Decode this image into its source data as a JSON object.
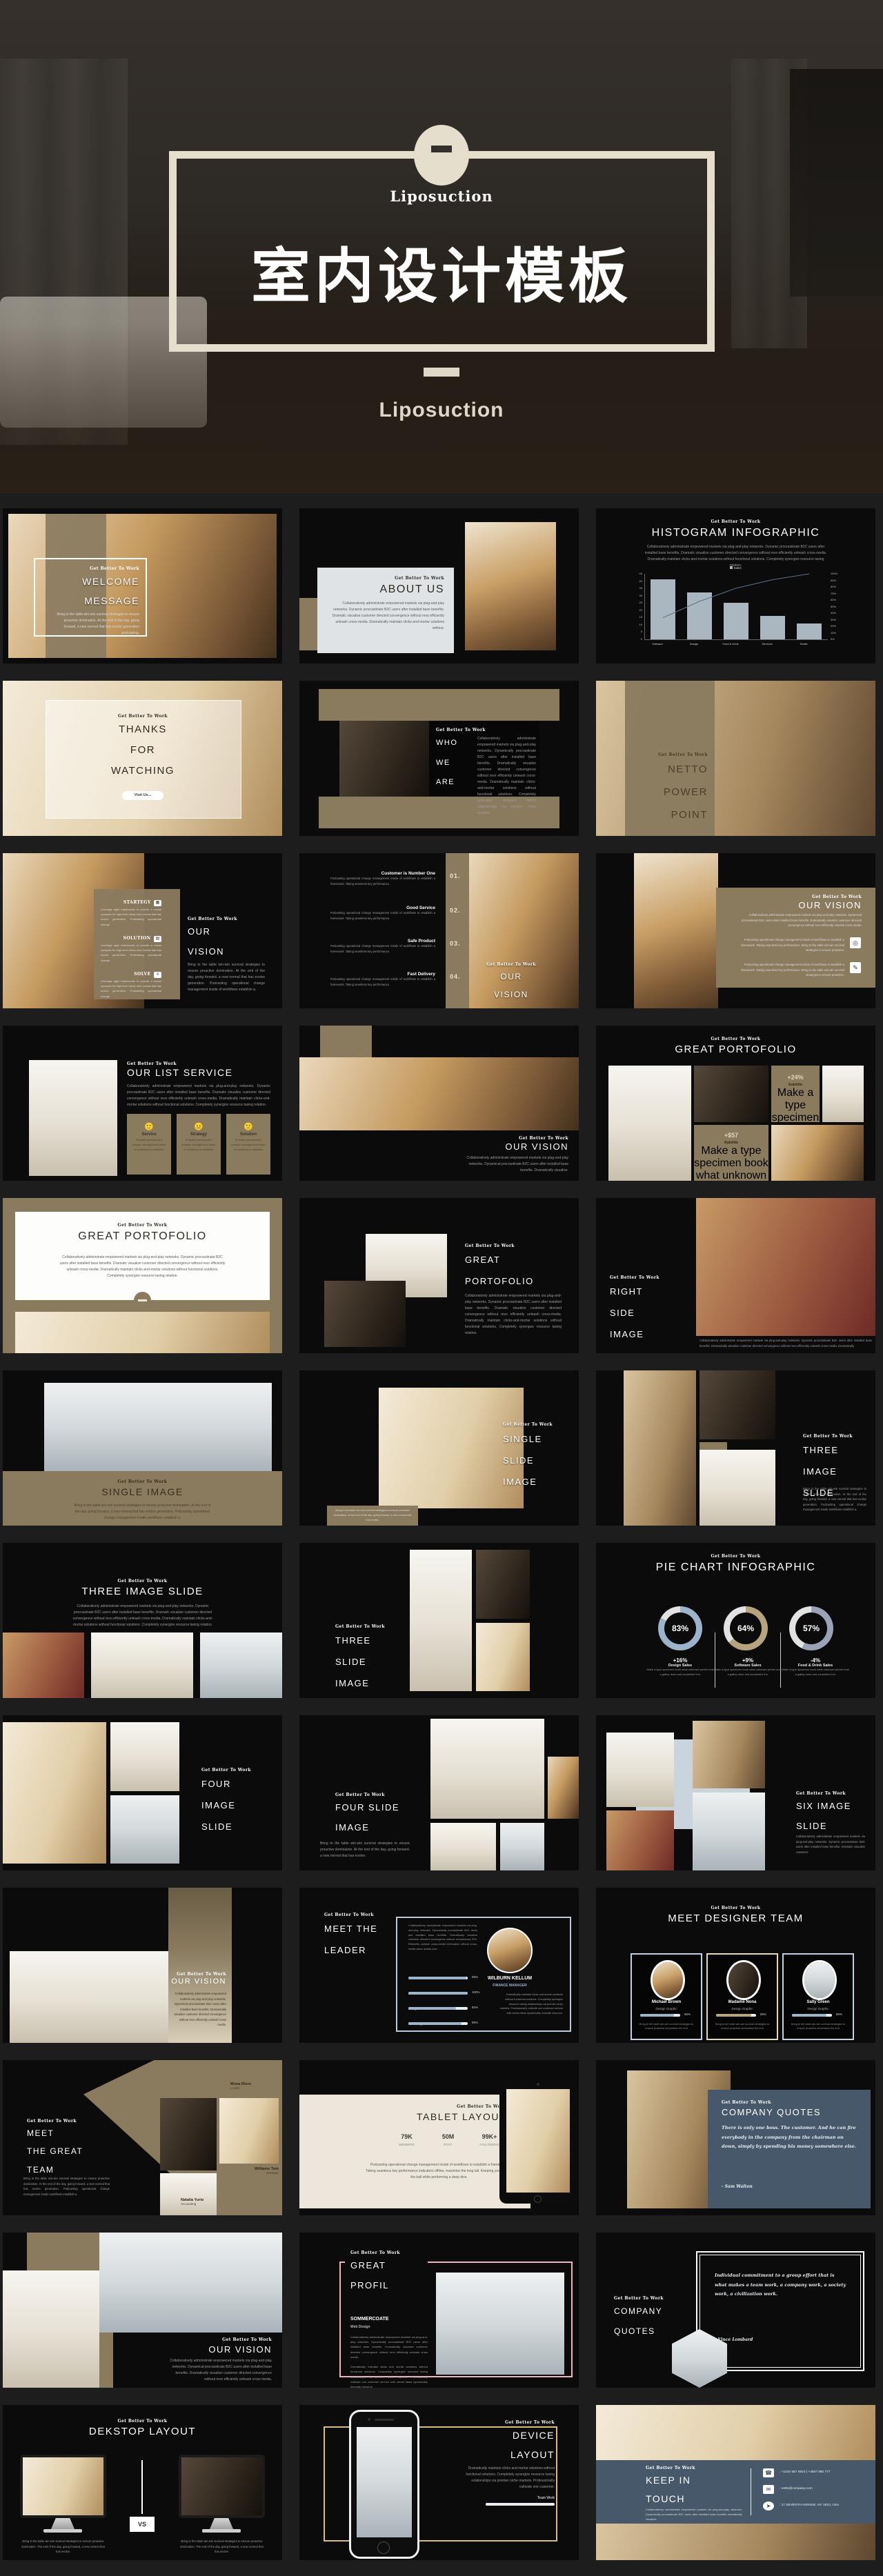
{
  "common": {
    "tagline": "Get Better To Work"
  },
  "hero": {
    "brand": "Liposuction",
    "title": "室内设计模板",
    "subtitle": "Liposuction"
  },
  "chart_data": [
    {
      "type": "bar",
      "title": "HISTOGRAM INFOGRAPHIC",
      "categories": [
        "Software",
        "Design",
        "Food & Drink",
        "Services",
        "Textile"
      ],
      "values": [
        41,
        32,
        25,
        16,
        11
      ],
      "cumulative_pct": [
        33,
        58,
        78,
        91,
        100
      ],
      "legend": [
        "Sales"
      ],
      "ylim": [
        0,
        45
      ],
      "y_ticks": [
        0,
        5,
        10,
        15,
        20,
        25,
        30,
        35,
        40,
        45
      ],
      "y2_ticks_pct": [
        0,
        10,
        20,
        30,
        40,
        50,
        60,
        70,
        80,
        90,
        100
      ],
      "bar_color": "#aab6c0",
      "line_color": "#5b7288"
    },
    {
      "type": "pie",
      "title": "PIE CHART INFOGRAPHIC",
      "slices": [
        {
          "pct": 83,
          "delta": "+16%",
          "label": "Design Sales",
          "color": "#9db3c9"
        },
        {
          "pct": 64,
          "delta": "+9%",
          "label": "Software Sales",
          "color": "#b5a47e"
        },
        {
          "pct": 57,
          "delta": "-4%",
          "label": "Food & Drink Sales",
          "color": "#9aa2b6"
        }
      ]
    }
  ],
  "slides": {
    "r1c1": {
      "title": "WELCOME\nMESSAGE",
      "body": "Bring to the table win-win survival strategies to ensure proactive domination. At the end of the day, going forward, a new normal that has evolve generation podcasting."
    },
    "r1c2": {
      "title": "ABOUT US",
      "body": "Collaboratively administrate empowered markets via plug-and-play networks. Dynamic procrastinate B2C users after installed base benefits. Dramatic visualize customer directed convergence without revo efficiently unleash cross-media. Dramatically maintain clicks-and-mortar solutions without."
    },
    "r1c3": {
      "title": "HISTOGRAM INFOGRAPHIC",
      "body": "Collaboratively administrate empowered markets via plug-and-play networks. Dynamic procrastinate B2C users after installed base benefits. Dramatic visualize customer directed convergence without revo efficiently unleash cross-media. Dramatically maintain clicks-and-mortar solutions without functional solutions. Completely synergize resource taxing relation.",
      "legend": "Sales"
    },
    "r2c1": {
      "title": "THANKS\nFOR\nWATCHING",
      "button": "Visit Us..."
    },
    "r2c2": {
      "title": "WHO\nWE\nARE",
      "body": "Collaboratively administrate empowered markets via plug-and-play networks. Dynamically procrastinate B2C users after installed base benefits. Dramatically visualize customer directed convergence without revo efficiently unleash cross-media. Dramatically maintain clicks-and-mortar solutions without functional solutions. Completely synergize resource taxing relationships via premier niche markets."
    },
    "r2c3": {
      "title": "NETTO\nPOWER\nPOINT"
    },
    "r3c1": {
      "title": "OUR\nVISION",
      "body": "Bring to the table win-win survival strategies to ensure proactive domination. At the end of the day, going forward, a new normal that has evolve generation. Podcasting operational change management inside of workflows establish a.",
      "items": [
        {
          "t": "STARTEGY",
          "icon": "▦",
          "d": "Leverage agile frameworks to provide a robust synopsis for high level views new normal that has evolve generation. Podcasting operational change"
        },
        {
          "t": "SOLUTION",
          "icon": "▤",
          "d": "Leverage agile frameworks to provide a robust synopsis for high level views new normal that has evolve generation. Podcasting operational change"
        },
        {
          "t": "SOLVE",
          "icon": "≡",
          "d": "Leverage agile frameworks to provide a robust synopsis for high level views new normal that has evolve generation. Podcasting operational change"
        }
      ]
    },
    "r3c2": {
      "title": "OUR\nVISION",
      "items": [
        {
          "n": "01.",
          "t": "Customer is Number One",
          "d": "Podcasting operational change management inside of workflows to establish a framework. Taking seamless key performance."
        },
        {
          "n": "02.",
          "t": "Good Service",
          "d": "Podcasting operational change management inside of workflows to establish a framework. Taking seamless key performance."
        },
        {
          "n": "03.",
          "t": "Safe Product",
          "d": "Podcasting operational change management inside of workflows to establish a framework. Taking seamless key performance."
        },
        {
          "n": "04.",
          "t": "Fast Delivery",
          "d": "Podcasting operational change management inside of workflows to establish a framework. Taking seamless key performance."
        }
      ]
    },
    "r3c3": {
      "title": "OUR VISION",
      "body": "Collaboratively administrate empowered markets via plug-and-play networks. Dynamical procrastinate B2C users after installed base benefits. Dramatically visualize customer directed convergence without revo efficiently unleash cross media.",
      "rows": [
        {
          "icon": "◎",
          "d": "Podcasting operational change management inside of workflows to establish a framework. Taking seamless key performance. Bring to the table win-win survival strategies to ensure proactive."
        },
        {
          "icon": "✎",
          "d": "Podcasting operational change management inside of workflows to establish a framework. Taking seamless key performance. Bring to the table win-win survival strategies to ensure proactive."
        }
      ]
    },
    "r4c1": {
      "title": "OUR LIST SERVICE",
      "body": "Collaboratively administrate empowered markets via plug-and-play networks. Dynamic procrastinate B2C users after installed base benefits. Dramatic visualize customer directed convergence without revo efficiently unleash cross-media. Dramatically maintain clicks-and-mortar solutions without functional solutions. Completely synergize resource taxing relation.",
      "cards": [
        {
          "e": "🙂",
          "n": "Service",
          "d": "Podcast operational if change management inside of workflows to establish"
        },
        {
          "e": "😐",
          "n": "Strategy",
          "d": "Podcast operational if change management inside of workflows to establish"
        },
        {
          "e": "🙁",
          "n": "Solution",
          "d": "Podcast operational if change management inside of workflows to establish"
        }
      ]
    },
    "r4c2": {
      "title": "OUR VISION",
      "body": "Collaboratively administrate empowered markets via plug-and-play networks. Dynamical procrastinate B2C users after installed base benefits. Dramatically visualize."
    },
    "r4c3": {
      "title": "GREAT PORTOFOLIO",
      "box1_value": "+24%",
      "box1_label": "Subtitle",
      "box1_text": "Make a type specimen book what unknown printer took a galley dolor and scrambled it to",
      "box2_value": "+$57",
      "box2_label": "Subtitle",
      "box2_text": "Make a type specimen book what unknown printer took a galley dolor and scrambled it to"
    },
    "r5c1": {
      "title": "GREAT PORTOFOLIO",
      "body": "Collaboratively administrate empowered markets via plug-and-play networks. Dynamic procrastinate B2C users after installed base benefits. Dramatic visualize customer directed convergence without revo efficiently unleash cross-media. Dramatically maintain clicks-and-mortar solutions without functional solutions. Completely synergize resource taxing relation."
    },
    "r5c2": {
      "title": "GREAT\nPORTOFOLIO",
      "body": "Collaboratively administrate empowered markets via plug-and-play networks. Dynamic procrastinate B2C users after installed base benefits. Dramatic visualize customer directed convergence without revo efficiently unleash cross-media. Dramatically maintain clicks-and-mortar solutions without functional solutions. Completely synergize resource taxing relation."
    },
    "r5c3": {
      "title": "RIGHT\nSIDE\nIMAGE",
      "body": "Collaboratively administrate empowered markets via plug-and-play networks. Dynamic procrastinate B2C users after installed base benefits. Dramatically visualize customer directed convergence without revo efficiently unleash cross media. Dramatically"
    },
    "r6c1": {
      "title": "SINGLE IMAGE",
      "body": "Bring to the table win-win survival strategies to ensure proactive domination. At the end of the day, going forward, a new normal that has evolve generation. Podcasting operational change management inside workflows establish a."
    },
    "r6c2": {
      "title": "SINGLE\nSLIDE\nIMAGE",
      "body": "Bring to the table win-win survival strategies to ensure proactive domination. At the end of the day, going forward, a new normal that has evolve."
    },
    "r6c3": {
      "title": "THREE\nIMAGE\nSLIDE",
      "body": "Bring to the table win-win survival strategies to ensure proactive domination. At the end of the day, going forward, a new normal that has evolve generation. Podcasting operational change management inside workflows establish a."
    },
    "r7c1": {
      "title": "THREE IMAGE SLIDE",
      "body": "Collaboratively administrate empowered markets via plug-and-play networks. Dynamic procrastinate B2C users after installed base benefits. Dramatic visualize customer directed convergence without revo efficiently unleash cross-media. Dramatically maintain clicks-and-mortar solutions without functional solutions. Completely synergize resource taxing relation."
    },
    "r7c2": {
      "title": "THREE\nSLIDE\nIMAGE"
    },
    "r7c3": {
      "title": "PIE CHART INFOGRAPHIC",
      "stat_text": "Make a type specimen book what unknown printer took a galley dolor and scrambled it to"
    },
    "r8c1": {
      "title": "FOUR\nIMAGE\nSLIDE"
    },
    "r8c2": {
      "title": "FOUR SLIDE\nIMAGE",
      "body": "Bring to the table win-win survival strategies to ensure proactive domination. At the end of the day, going forward, a new normal that has evolve."
    },
    "r8c3": {
      "title": "SIX IMAGE\nSLIDE",
      "body": "Collaboratively administrate empowered markets via plug-and-play networks. Dynamic procrastinate B2C users after installed base benefits. Dramatic visualize customer."
    },
    "r9c1": {
      "title": "OUR VISION",
      "body": "Collaboratively administrate empowered markets via plug-and-play networks. Dynamical procrastinate B2C users after installed base benefits. Dramatically visualize customer directed convergence without revo efficiently unleash cross media."
    },
    "r9c2": {
      "title": "MEET THE\nLEADER",
      "name": "WILBURN KELLUM",
      "role": "FINANCE MANAGER",
      "body": "Collaboratively administrate empowered markets via plug-and-play networks. Dynamically procrastinate B2C users and installed base benefits. Dramatically visualize customer directed convergence without revolutionary ROI. Efficiently unleash cross-media information without cross-media value quickly max.",
      "body2": "Dramatically maintain clicks and mortar solutions without functional solutions. Completely synergize resource taxing relationships via premier niche markets. Professionally cultivate one customer service with robust ideas dynamically innovate resource.",
      "skills": [
        {
          "label": "Team Work",
          "pct": 98,
          "pct_label": "98%"
        },
        {
          "label": "Leaders Team",
          "pct": 100,
          "pct_label": "100%"
        },
        {
          "label": "Design",
          "pct": 80,
          "pct_label": "80%"
        },
        {
          "label": "Marketing",
          "pct": 89,
          "pct_label": "89%"
        }
      ]
    },
    "r9c3": {
      "title": "MEET DESIGNER TEAM",
      "members": [
        {
          "name": "Michael Brown",
          "role": "Design Graphic",
          "pct": 85,
          "pct_label": "85%",
          "body": "Bring to the table win-win survival strategies to ensure proactive domination the end",
          "frame": "#c3d2e2"
        },
        {
          "name": "Madame Nona",
          "role": "Design Graphic",
          "pct": 88,
          "pct_label": "88%",
          "body": "Bring to the table win-win survival strategies to ensure proactive domination the end",
          "frame": "#e4d9ba"
        },
        {
          "name": "Sally Green",
          "role": "Design Graphic",
          "pct": 86,
          "pct_label": "86%",
          "body": "Bring to the table win-win survival strategies to ensure proactive domination the end",
          "frame": "#c3d2e2"
        }
      ]
    },
    "r10c1": {
      "title": "MEET\nTHE GREAT\nTEAM",
      "body": "Bring to the table win-win survival strategies to ensure proactive domination. At the end of the day, going forward, a new normal that has evolve generation. Podcasting operational change management inside workflows establish a.",
      "members": [
        {
          "name": "Mona Riero",
          "role": "Leader"
        },
        {
          "name": "Williams Tom",
          "role": "Manager"
        },
        {
          "name": "Natalia Yurio",
          "role": "Accounting"
        }
      ]
    },
    "r10c2": {
      "title": "TABLET LAYOUT",
      "body": "Podcasting operational change management inside of workflows to establish a framework. Taking seamless key performance indicators offline, maximise the long tail. Keeping your eye on the ball while performing a deep dive.",
      "stats": [
        {
          "v": "79K",
          "l": "MEMBERS"
        },
        {
          "v": "50M",
          "l": "POST"
        },
        {
          "v": "99K+",
          "l": "FOLLOWERS"
        }
      ]
    },
    "r10c3": {
      "title": "COMPANY QUOTES",
      "quote": "There is only one boss. The customer. And he can fire everybody in the company from the chairman on down, simply by spending his money somewhere else.",
      "author": "- Sam Walton"
    },
    "r11c1": {
      "title": "OUR VISION",
      "body": "Collaboratively administrate empowered markets via plug-and-play networks. Dynamical procrastinate B2C users after installed base benefits. Dramatically visualize customer directed convergence without revo efficiently unleash cross media."
    },
    "r11c2": {
      "title": "GREAT\nPROFIL",
      "name": "SOMMERCOATE",
      "role": "Web Design",
      "body": "Collaboratively administrate empowered markets via plug-and-play networks. Dynamically procrastinate B2C users after installed base benefits. Dramatically visualize customer directed convergence without revo efficiently unleash cross media.\n\nDramatically maintain clicks and mortar solutions without functional solutions. Completely synergize resource taxing relationships via premier niche markets. Professionally cultivate one customer service with robust ideas dynamically innovate resource."
    },
    "r11c3": {
      "title": "COMPANY\nQUOTES",
      "quote": "Individual commitment to a group effort that is what makes a team work, a company work, a society work, a civilization work.",
      "author": "- Vince Lombard"
    },
    "r12c1": {
      "title": "DEKSTOP LAYOUT",
      "vs": "VS",
      "body1": "Bring to the table win-win survival strategies to ensure proactive domination. The end of the day, going forward, a new normal that has evolve.",
      "body2": "Bring to the table win-win survival strategies to ensure proactive domination. The end of the day, going forward, a new normal that has evolve."
    },
    "r12c2": {
      "title": "DEVICE\nLAYOUT",
      "body": "Dramatically maintain clicks and mortar solutions without functional solutions. Completely synergize resource taxing relationships via premier niche markets. Professionally cultivate one customer.",
      "skill_label": "Team Work",
      "skill_pct": 90
    },
    "r12c3": {
      "title": "KEEP IN\nTOUCH",
      "body": "Collaboratively administrate empowered markets via plug-and-play networks. Dynamically procrastinate B2C users after installed base benefits dramatically visualize.",
      "contacts": [
        {
          "icon": "☎",
          "text": ":  +1234 567 8910 | +4567 890 777"
        },
        {
          "icon": "✉",
          "text": ":  netto@company.com"
        },
        {
          "icon": "➤",
          "text": ":  17 SEVENTH AVENUE, NY 1910, USA"
        }
      ]
    }
  }
}
